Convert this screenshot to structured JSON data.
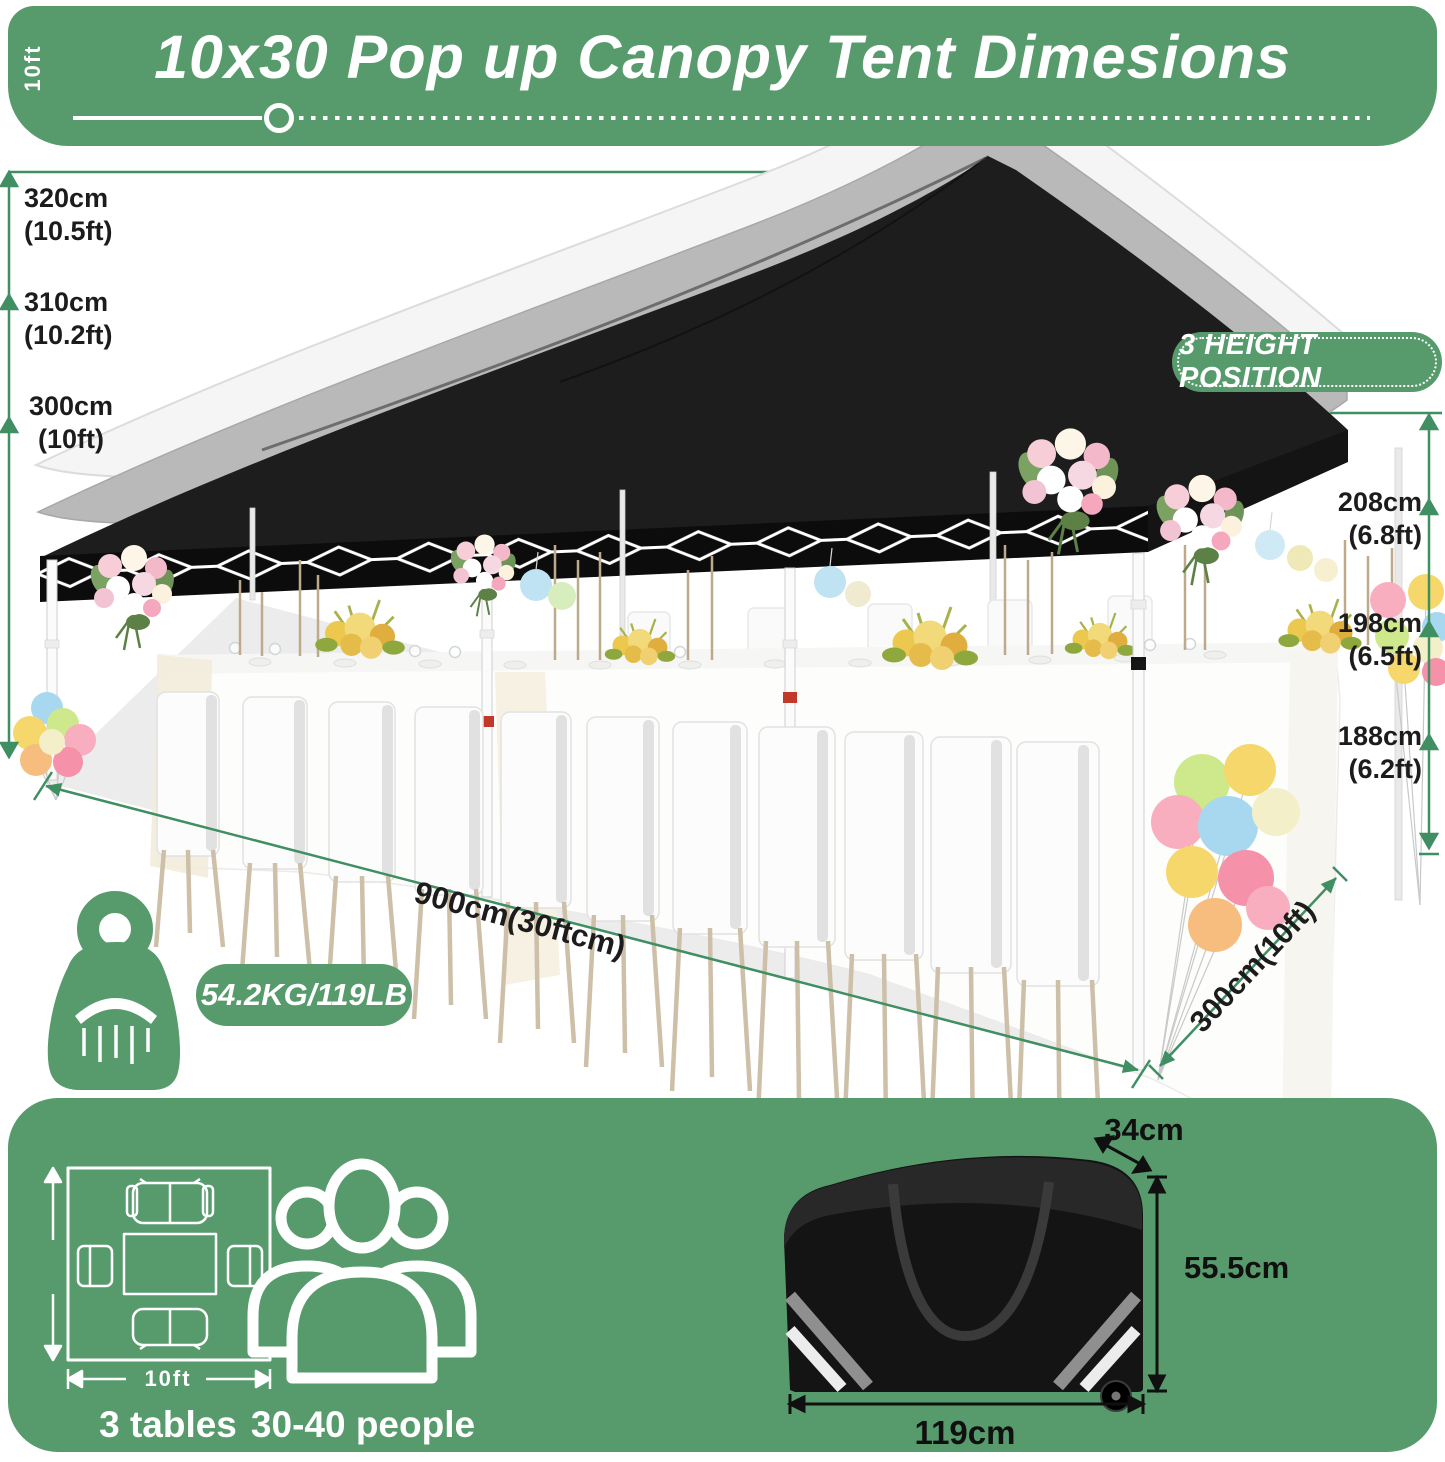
{
  "header": {
    "title": "10x30 Pop up Canopy Tent Dimesions"
  },
  "height_badge": {
    "label": "3 HEIGHT POSITION"
  },
  "peak_heights": [
    {
      "cm": "320cm",
      "ft": "(10.5ft)"
    },
    {
      "cm": "310cm",
      "ft": "(10.2ft)"
    },
    {
      "cm": "300cm",
      "ft": "(10ft)"
    }
  ],
  "side_heights": [
    {
      "cm": "208cm",
      "ft": "(6.8ft)"
    },
    {
      "cm": "198cm",
      "ft": "(6.5ft)"
    },
    {
      "cm": "188cm",
      "ft": "(6.2ft)"
    }
  ],
  "footprint": {
    "length": "900cm(30ftcm)",
    "depth": "300cm(10ft)"
  },
  "weight": {
    "value": "54.2KG/119LB"
  },
  "layout_diagram": {
    "width_label": "10ft",
    "height_label": "10ft",
    "caption": "3 tables"
  },
  "capacity": {
    "caption": "30-40 people"
  },
  "storage_bag": {
    "depth": "34cm",
    "height": "55.5cm",
    "width": "119cm"
  },
  "colors": {
    "brand_green": "#579b6d",
    "arrow_green": "#3f8f63",
    "canopy_black": "#1d1d1d"
  }
}
